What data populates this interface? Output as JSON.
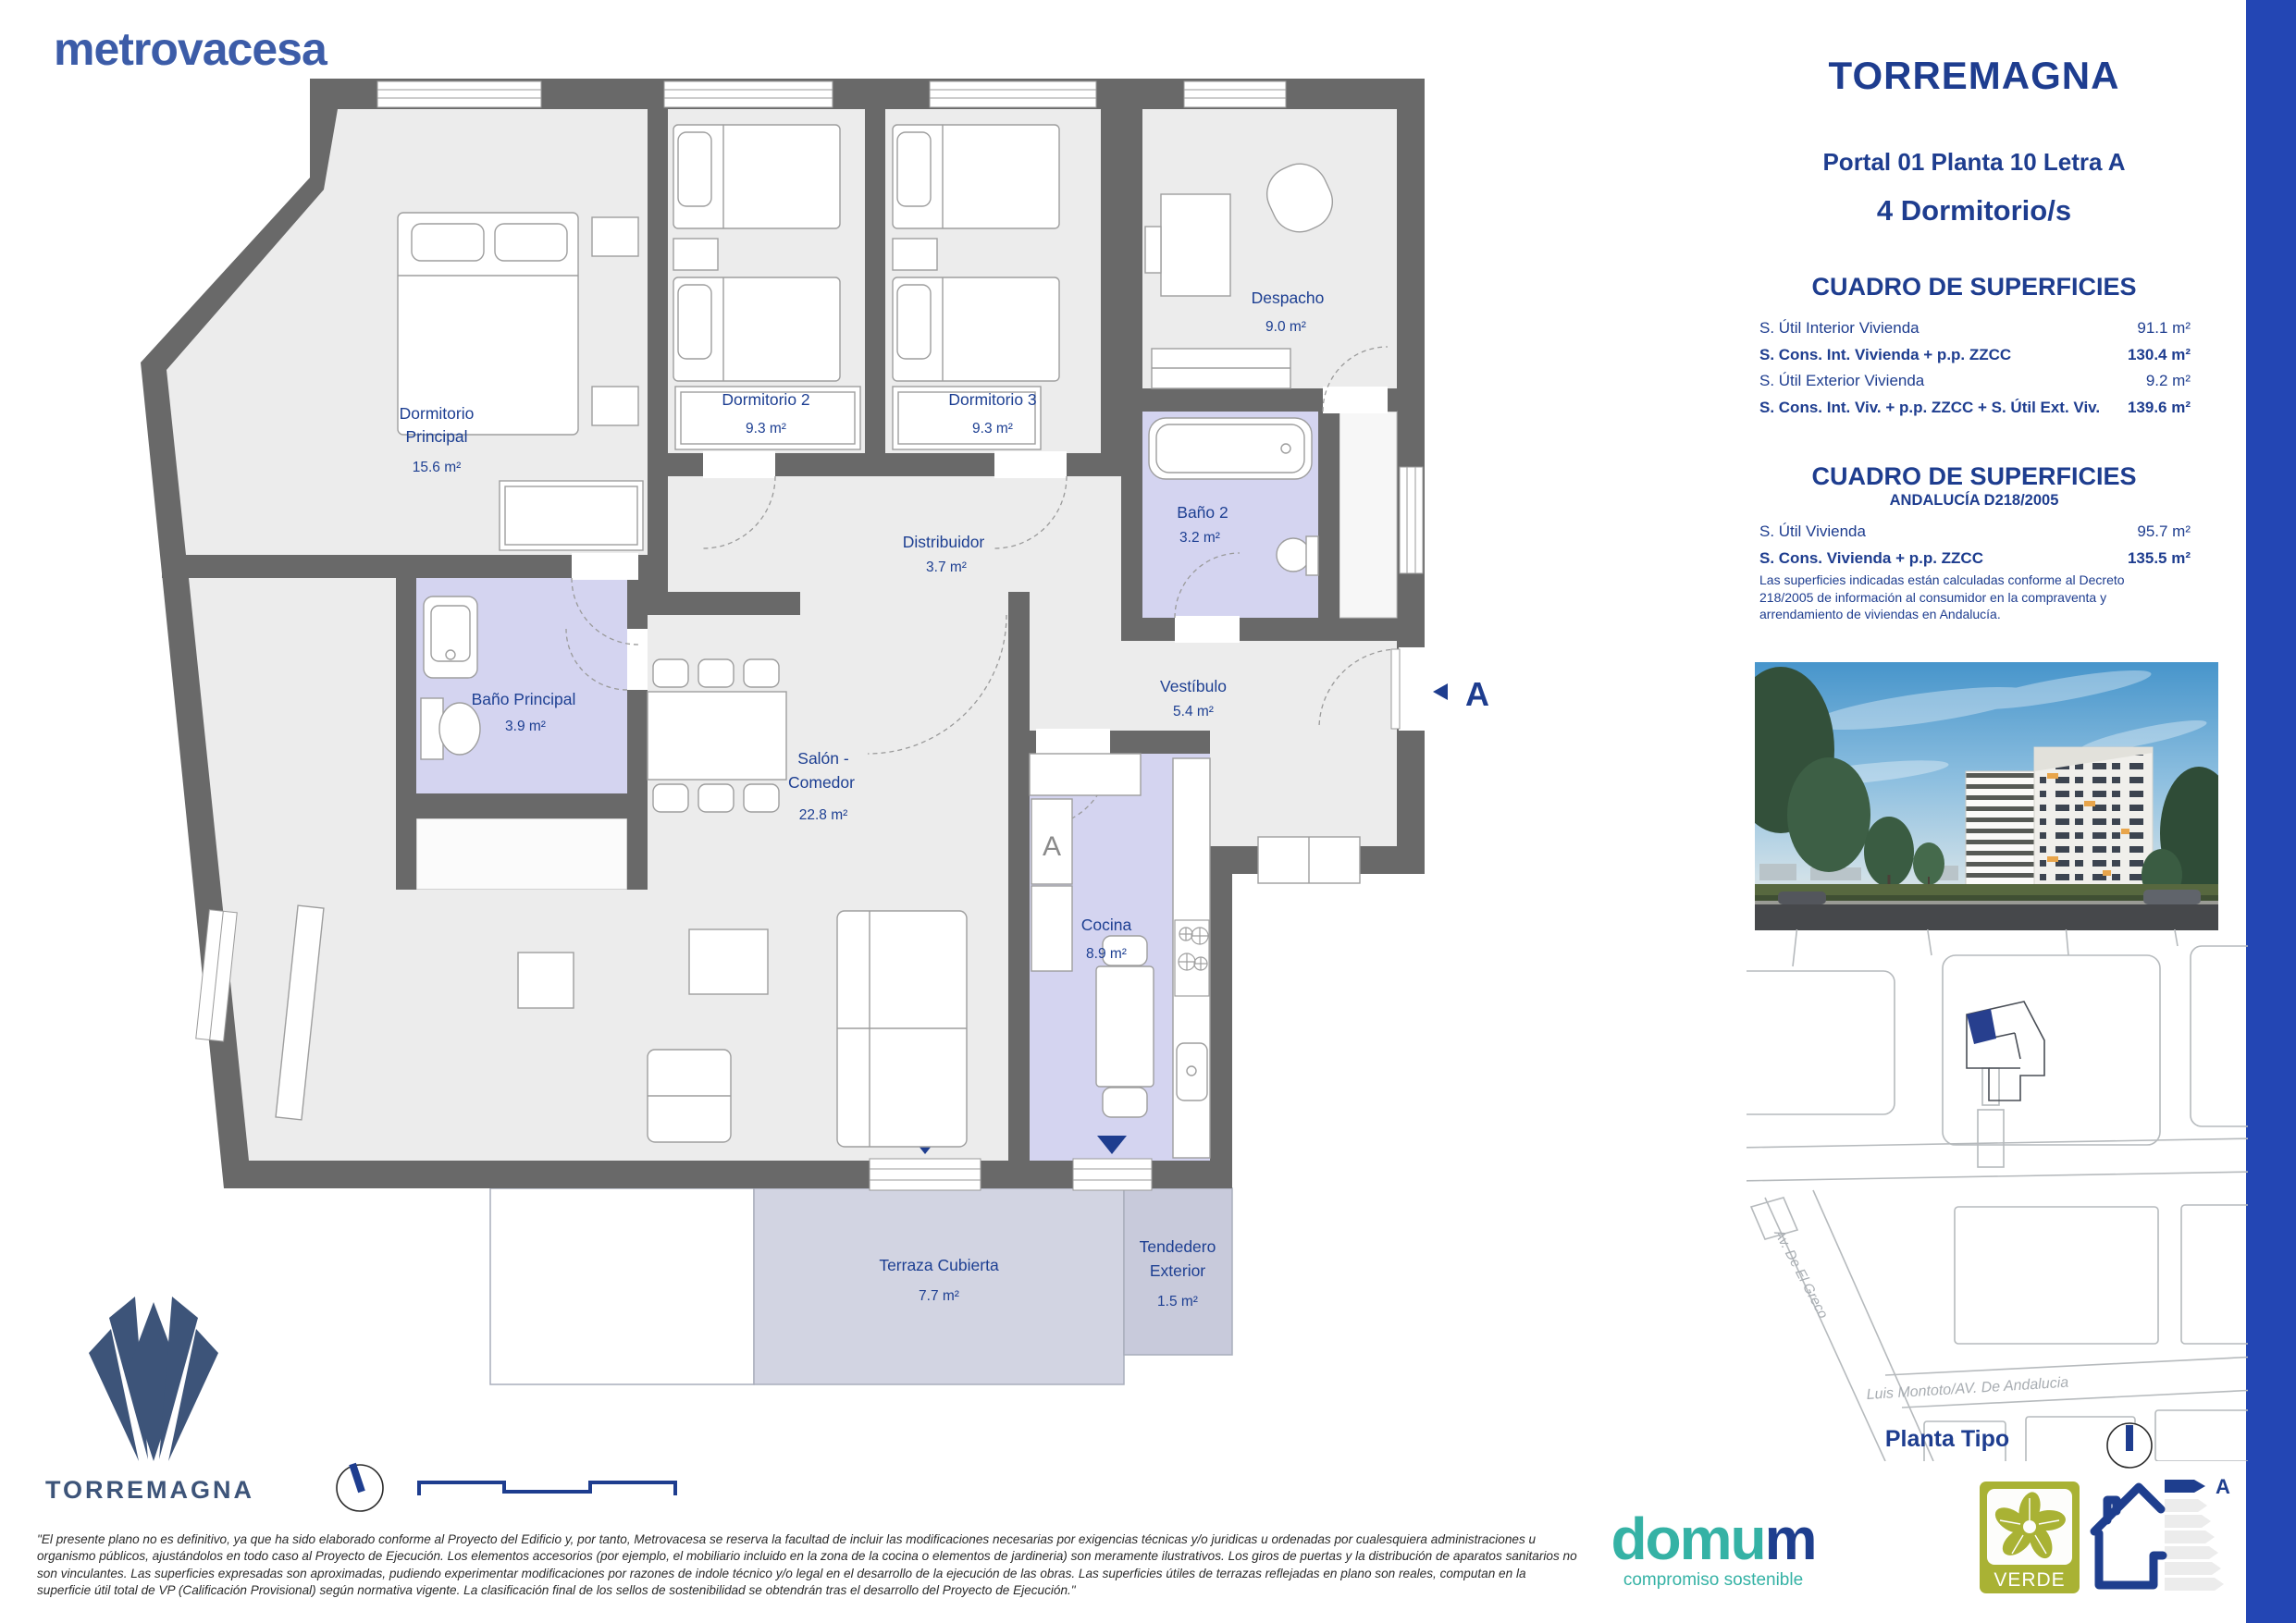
{
  "brand": {
    "logo": "metrovacesa"
  },
  "header": {
    "title": "TORREMAGNA",
    "subtitle": "Portal 01 Planta 10 Letra A",
    "bedrooms": "4 Dormitorio/s"
  },
  "surfaces_table": {
    "title": "CUADRO DE SUPERFICIES",
    "rows": [
      {
        "label": "S. Útil Interior Vivienda",
        "value": "91.1 m²"
      },
      {
        "label": "S. Cons. Int. Vivienda + p.p. ZZCC",
        "value": "130.4 m²"
      },
      {
        "label": "S. Útil Exterior Vivienda",
        "value": "9.2 m²"
      },
      {
        "label": "S. Cons. Int. Viv. + p.p. ZZCC + S. Útil Ext. Viv.",
        "value": "139.6 m²"
      }
    ]
  },
  "surfaces_table_andalucia": {
    "title": "CUADRO DE SUPERFICIES",
    "subtitle": "ANDALUCÍA D218/2005",
    "rows": [
      {
        "label": "S. Útil Vivienda",
        "value": "95.7 m²"
      },
      {
        "label": "S. Cons. Vivienda + p.p. ZZCC",
        "value": "135.5 m²"
      }
    ],
    "note": "Las superficies indicadas están calculadas conforme al Decreto 218/2005 de información al consumidor en la compraventa y arrendamiento de viviendas en Andalucía."
  },
  "floorplan": {
    "rooms": {
      "dorm_ppal": {
        "l1": "Dormitorio",
        "l2": "Principal",
        "area": "15.6 m²"
      },
      "dorm2": {
        "l1": "Dormitorio 2",
        "area": "9.3 m²"
      },
      "dorm3": {
        "l1": "Dormitorio 3",
        "area": "9.3 m²"
      },
      "despacho": {
        "l1": "Despacho",
        "area": "9.0 m²"
      },
      "bano2": {
        "l1": "Baño 2",
        "area": "3.2 m²"
      },
      "distribuidor": {
        "l1": "Distribuidor",
        "area": "3.7 m²"
      },
      "bano_ppal": {
        "l1": "Baño Principal",
        "area": "3.9 m²"
      },
      "vestibulo": {
        "l1": "Vestíbulo",
        "area": "5.4 m²"
      },
      "salon": {
        "l1": "Salón -",
        "l2": "Comedor",
        "area": "22.8 m²"
      },
      "cocina": {
        "l1": "Cocina",
        "area": "8.9 m²"
      },
      "terraza": {
        "l1": "Terraza Cubierta",
        "area": "7.7 m²"
      },
      "tendedero": {
        "l1": "Tendedero",
        "l2": "Exterior",
        "area": "1.5 m²"
      }
    },
    "section_marker": "A",
    "fridge_label": "A"
  },
  "map": {
    "street_diagonal": "Av. De El Greco",
    "street_bottom": "Luis Montoto/AV. De Andalucia",
    "caption": "Planta Tipo"
  },
  "footer": {
    "project_logo": "TORREMAGNA",
    "disclaimer": "\"El presente plano no es definitivo, ya que ha sido elaborado conforme al Proyecto del Edificio y, por tanto, Metrovacesa se reserva la facultad de incluir las modificaciones necesarias por exigencias técnicas y/o juridicas u ordenadas por cualesquiera administraciones u organismo públicos, ajustándolos en todo caso al Proyecto de Ejecución. Los elementos accesorios (por ejemplo, el mobiliario incluido en la zona de la cocina o elementos de jardineria) son meramente ilustrativos. Los giros de puertas y la distribución de aparatos sanitarios no son vinculantes. Las superficies expresadas son aproximadas, pudiendo experimentar modificaciones por razones de indole técnico y/o legal en el desarrollo de la ejecución de las obras. Las superficies útiles de terrazas reflejadas en plano son reales, computan en la superficie útil total de VP (Calificación Provisional) según normativa vigente. La clasificación final de los sellos de sostenibilidad se obtendrán tras el desarrollo del Proyecto de Ejecución.\"",
    "domum": {
      "part1": "domu",
      "part2": "m",
      "tagline": "compromiso sostenible"
    },
    "verde_label": "VERDE",
    "energy_rating": "A"
  },
  "colors": {
    "navy": "#1e3d8f",
    "stripe_blue": "#2346b4",
    "wall_gray": "#696969",
    "room_gray": "#ececec",
    "wet_lavender": "#d4d4f0",
    "terrace": "#d2d4e2",
    "metrovacesa_blue": "#3c5ca8",
    "domum_teal": "#35b2a5",
    "verde_olive": "#a9b234",
    "logo_navy": "#3d5479"
  }
}
